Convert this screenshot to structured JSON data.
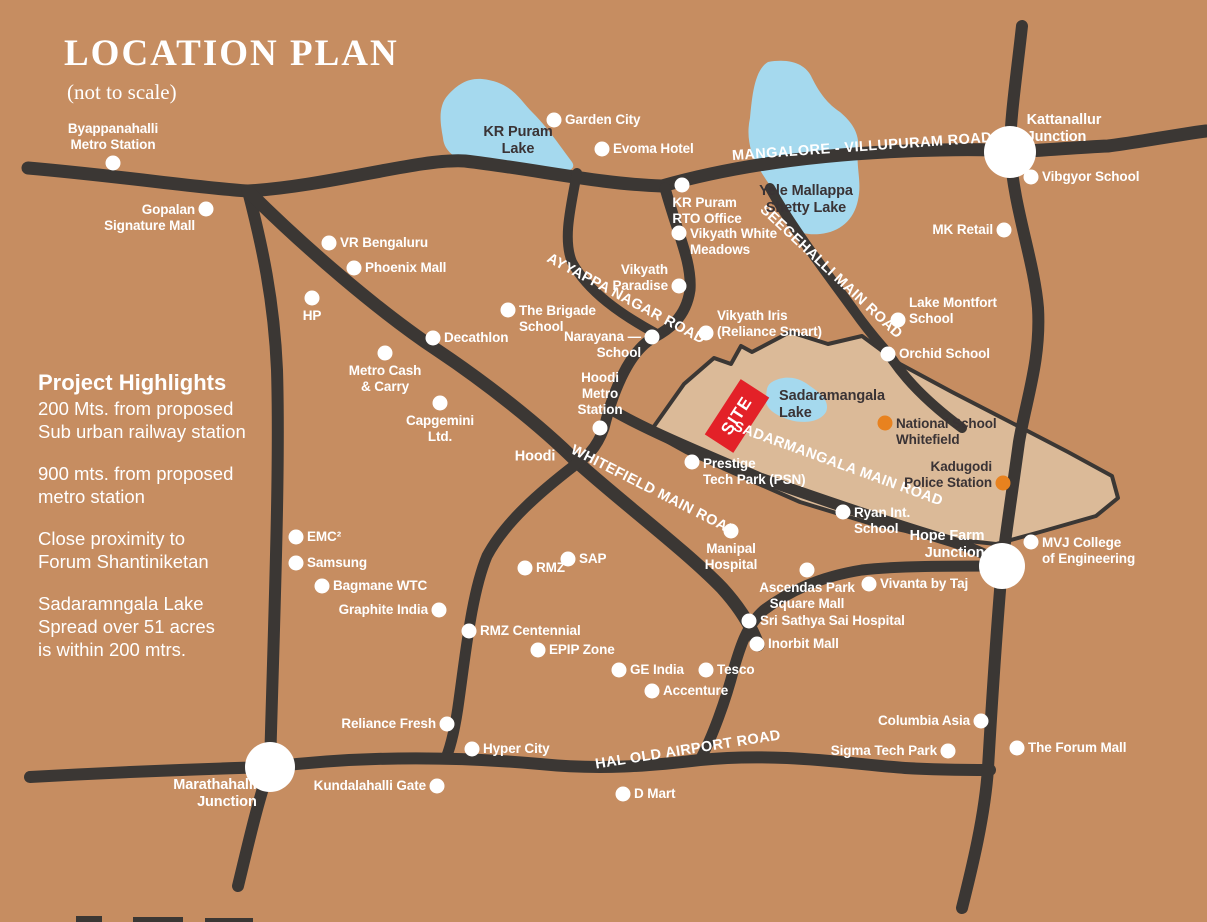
{
  "header": {
    "title": "LOCATION PLAN",
    "subtitle": "(not to scale)"
  },
  "highlights": {
    "title": "Project Highlights",
    "items": [
      "200 Mts. from proposed\nSub urban railway station",
      "900 mts. from proposed\nmetro station",
      "Close proximity to\nForum Shantiniketan",
      "Sadaramngala Lake\nSpread over 51 acres\nis within 200 mtrs."
    ]
  },
  "site": {
    "label": "SITE"
  },
  "colors": {
    "background": "#c68d61",
    "road": "#3b3734",
    "water": "#a5d9ee",
    "site_area": "#dbba98",
    "site_marker": "#e32128",
    "dot_white": "#ffffff",
    "dot_orange": "#e8821f",
    "text_light": "#ffffff",
    "text_dark": "#3a3335"
  },
  "map": {
    "road_labels": [
      {
        "id": "mangalore-villupuram-road",
        "label": "MANGALORE - VILLUPURAM ROAD",
        "x": 862,
        "y": 147,
        "rot": -4
      },
      {
        "id": "seegehalli-main-road",
        "label": "SEEGEHALLI MAIN ROAD",
        "x": 831,
        "y": 272,
        "rot": 43
      },
      {
        "id": "ayyappa-nagar-road",
        "label": "AYYAPPA NAGAR ROAD",
        "x": 626,
        "y": 299,
        "rot": 28
      },
      {
        "id": "whitefield-main-road",
        "label": "WHITEFIELD MAIN ROAD",
        "x": 654,
        "y": 491,
        "rot": 27
      },
      {
        "id": "sadarmangala-main-road",
        "label": "SADARMANGALA MAIN ROAD",
        "x": 838,
        "y": 464,
        "rot": 20
      },
      {
        "id": "hal-old-airport-road",
        "label": "HAL OLD AIRPORT ROAD",
        "x": 688,
        "y": 750,
        "rot": -9
      }
    ],
    "places": [
      {
        "label": "Byappanahalli\nMetro Station",
        "x": 113,
        "y": 163,
        "dot": "white",
        "side": "above",
        "align": "center"
      },
      {
        "label": "Gopalan\nSignature Mall",
        "x": 206,
        "y": 209,
        "dot": "white",
        "side": "left",
        "align": "right",
        "dy": 9
      },
      {
        "label": "Garden City",
        "x": 554,
        "y": 120,
        "dot": "white",
        "side": "right"
      },
      {
        "label": "Evoma Hotel",
        "x": 602,
        "y": 149,
        "dot": "white",
        "side": "right"
      },
      {
        "label": "KR Puram\nLake",
        "x": 518,
        "y": 141,
        "dot": "none",
        "align": "center",
        "dark": true,
        "bold": true
      },
      {
        "label": "Kattanallur\nJunction",
        "x": 1064,
        "y": 129,
        "dot": "none",
        "align": "left",
        "bold": true
      },
      {
        "label": "Vibgyor School",
        "x": 1031,
        "y": 177,
        "dot": "white",
        "side": "right"
      },
      {
        "label": "Yele Mallappa\nShetty Lake",
        "x": 806,
        "y": 200,
        "dot": "none",
        "align": "center",
        "dark": true,
        "bold": true
      },
      {
        "label": "MK Retail",
        "x": 1004,
        "y": 230,
        "dot": "white",
        "side": "left",
        "align": "right"
      },
      {
        "label": "VR Bengaluru",
        "x": 329,
        "y": 243,
        "dot": "white",
        "side": "right"
      },
      {
        "label": "Phoenix Mall",
        "x": 354,
        "y": 268,
        "dot": "white",
        "side": "right"
      },
      {
        "label": "KR Puram\nRTO Office",
        "x": 682,
        "y": 185,
        "dot": "white",
        "side": "below",
        "align": "left",
        "dx": 25
      },
      {
        "label": "Vikyath White\nMeadows",
        "x": 679,
        "y": 233,
        "dot": "white",
        "side": "right",
        "align": "left",
        "dy": 9
      },
      {
        "label": "Vikyath\nParadise",
        "x": 679,
        "y": 286,
        "dot": "white",
        "side": "left",
        "align": "right",
        "dy": -8
      },
      {
        "label": "HP",
        "x": 312,
        "y": 298,
        "dot": "white",
        "side": "below",
        "align": "center"
      },
      {
        "label": "The Brigade\nSchool",
        "x": 508,
        "y": 310,
        "dot": "white",
        "side": "right",
        "align": "left",
        "dy": 9
      },
      {
        "label": "Lake Montfort\nSchool",
        "x": 898,
        "y": 320,
        "dot": "white",
        "side": "right",
        "align": "left",
        "dy": -9
      },
      {
        "label": "Decathlon",
        "x": 433,
        "y": 338,
        "dot": "white",
        "side": "right"
      },
      {
        "label": "Vikyath Iris\n(Reliance Smart)",
        "x": 706,
        "y": 333,
        "dot": "white",
        "side": "right",
        "align": "left",
        "dy": -9
      },
      {
        "label": "Narayana —\nSchool",
        "x": 652,
        "y": 337,
        "dot": "white",
        "side": "left",
        "align": "right",
        "dy": 8
      },
      {
        "label": "Orchid School",
        "x": 888,
        "y": 354,
        "dot": "white",
        "side": "right"
      },
      {
        "label": "Metro Cash\n& Carry",
        "x": 385,
        "y": 353,
        "dot": "white",
        "side": "below",
        "align": "center"
      },
      {
        "label": "Sadaramangala\nLake",
        "x": 832,
        "y": 405,
        "dot": "none",
        "align": "left",
        "dark": true,
        "bold": true
      },
      {
        "label": "Hoodi\nMetro\nStation",
        "x": 600,
        "y": 428,
        "dot": "white",
        "side": "above",
        "align": "center"
      },
      {
        "label": "Capgemini\nLtd.",
        "x": 440,
        "y": 403,
        "dot": "white",
        "side": "below",
        "align": "center"
      },
      {
        "label": "National School\nWhitefield",
        "x": 885,
        "y": 423,
        "dot": "orange",
        "side": "right",
        "align": "left",
        "dy": 9,
        "dark": true
      },
      {
        "label": "Hoodi",
        "x": 535,
        "y": 457,
        "dot": "none",
        "align": "center",
        "bold": true
      },
      {
        "label": "Kadugodi\nPolice Station",
        "x": 1003,
        "y": 483,
        "dot": "orange",
        "side": "left",
        "align": "right",
        "dy": -8,
        "dark": true
      },
      {
        "label": "Prestige\nTech Park (PSN)",
        "x": 692,
        "y": 462,
        "dot": "white",
        "side": "right",
        "align": "left",
        "dy": 10
      },
      {
        "label": "EMC²",
        "x": 296,
        "y": 537,
        "dot": "white",
        "side": "right"
      },
      {
        "label": "Ryan Int.\nSchool",
        "x": 843,
        "y": 512,
        "dot": "white",
        "side": "right",
        "align": "left",
        "dy": 9
      },
      {
        "label": "Samsung",
        "x": 296,
        "y": 563,
        "dot": "white",
        "side": "right"
      },
      {
        "label": "Hope Farm\nJunction",
        "x": 947,
        "y": 545,
        "dot": "none",
        "align": "right",
        "bold": true
      },
      {
        "label": "MVJ College\nof Engineering",
        "x": 1031,
        "y": 542,
        "dot": "white",
        "side": "right",
        "align": "left",
        "dy": 9
      },
      {
        "label": "Manipal\nHospital",
        "x": 731,
        "y": 531,
        "dot": "white",
        "side": "below",
        "align": "center"
      },
      {
        "label": "Bagmane WTC",
        "x": 322,
        "y": 586,
        "dot": "white",
        "side": "right"
      },
      {
        "label": "SAP",
        "x": 568,
        "y": 559,
        "dot": "white",
        "side": "right"
      },
      {
        "label": "RMZ",
        "x": 525,
        "y": 568,
        "dot": "white",
        "side": "right"
      },
      {
        "label": "Ascendas Park\nSquare Mall",
        "x": 807,
        "y": 570,
        "dot": "white",
        "side": "below",
        "align": "center"
      },
      {
        "label": "Vivanta by Taj",
        "x": 869,
        "y": 584,
        "dot": "white",
        "side": "right"
      },
      {
        "label": "Graphite India",
        "x": 439,
        "y": 610,
        "dot": "white",
        "side": "left",
        "align": "right"
      },
      {
        "label": "Sri Sathya Sai Hospital",
        "x": 749,
        "y": 621,
        "dot": "white",
        "side": "right"
      },
      {
        "label": "RMZ Centennial",
        "x": 469,
        "y": 631,
        "dot": "white",
        "side": "right"
      },
      {
        "label": "Inorbit Mall",
        "x": 757,
        "y": 644,
        "dot": "white",
        "side": "right"
      },
      {
        "label": "EPIP Zone",
        "x": 538,
        "y": 650,
        "dot": "white",
        "side": "right"
      },
      {
        "label": "GE India",
        "x": 619,
        "y": 670,
        "dot": "white",
        "side": "right"
      },
      {
        "label": "Tesco",
        "x": 706,
        "y": 670,
        "dot": "white",
        "side": "right"
      },
      {
        "label": "Accenture",
        "x": 652,
        "y": 691,
        "dot": "white",
        "side": "right"
      },
      {
        "label": "Columbia Asia",
        "x": 981,
        "y": 721,
        "dot": "white",
        "side": "left",
        "align": "right"
      },
      {
        "label": "Reliance Fresh",
        "x": 447,
        "y": 724,
        "dot": "white",
        "side": "left",
        "align": "right"
      },
      {
        "label": "Hyper City",
        "x": 472,
        "y": 749,
        "dot": "white",
        "side": "right"
      },
      {
        "label": "Sigma Tech Park",
        "x": 948,
        "y": 751,
        "dot": "white",
        "side": "left",
        "align": "right"
      },
      {
        "label": "The Forum Mall",
        "x": 1017,
        "y": 748,
        "dot": "white",
        "side": "right"
      },
      {
        "label": "Marathahalli\nJunction",
        "x": 215,
        "y": 794,
        "dot": "none",
        "align": "right",
        "bold": true
      },
      {
        "label": "Kundalahalli Gate",
        "x": 437,
        "y": 786,
        "dot": "white",
        "side": "left",
        "align": "right"
      },
      {
        "label": "D Mart",
        "x": 623,
        "y": 794,
        "dot": "white",
        "side": "right"
      }
    ]
  }
}
